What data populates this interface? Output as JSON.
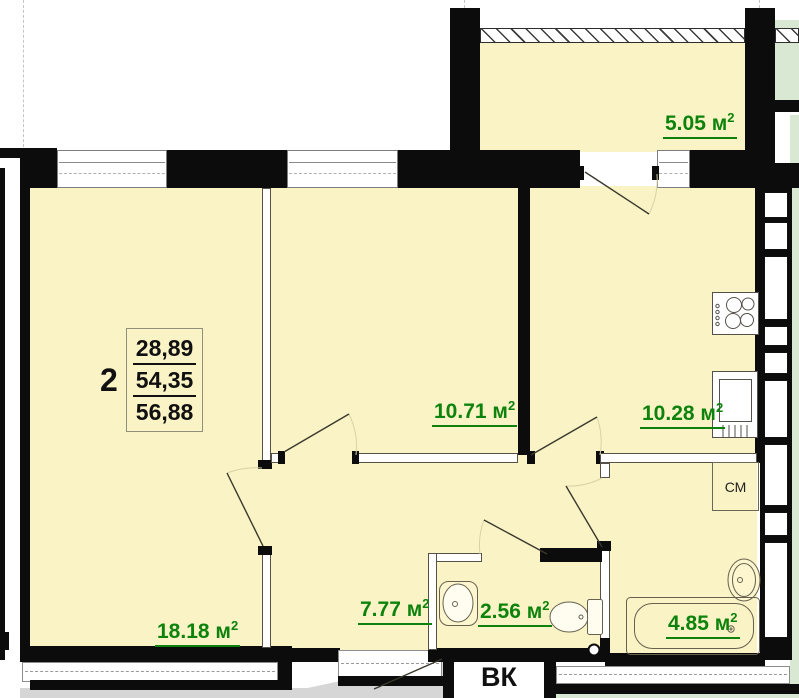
{
  "stamp": {
    "rooms_count": "2",
    "living_area": "28,89",
    "apartment_area": "54,35",
    "total_area": "56,88"
  },
  "rooms": [
    {
      "id": "living-room",
      "area": "18.18"
    },
    {
      "id": "bedroom",
      "area": "10.71"
    },
    {
      "id": "kitchen",
      "area": "10.28"
    },
    {
      "id": "balcony",
      "area": "5.05"
    },
    {
      "id": "hallway",
      "area": "7.77"
    },
    {
      "id": "wc",
      "area": "2.56"
    },
    {
      "id": "bathroom",
      "area": "4.85"
    }
  ],
  "unit": {
    "base": "м",
    "sup": "2"
  },
  "annotations": {
    "vent_shaft": "ВК",
    "washing_machine": "СМ"
  },
  "icons": [
    "stove-icon",
    "fridge-icon",
    "bathtub-icon",
    "bath-sink-icon",
    "wc-sink-icon",
    "toilet-icon",
    "pipe-riser-icon",
    "door-swing-icon"
  ],
  "colors": {
    "room_fill": "#faf3c5",
    "adjacent_fill": "#d9e8d2",
    "corridor_fill": "#d6d6d6",
    "wall": "#0c0c0c",
    "area_label": "#0d830d"
  }
}
